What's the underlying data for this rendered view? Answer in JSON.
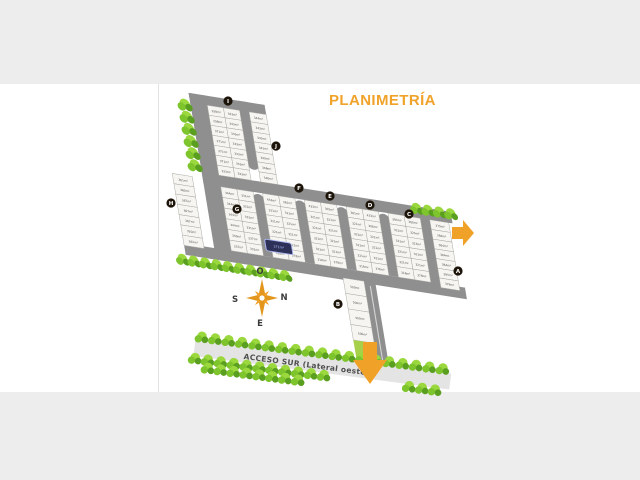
{
  "page": {
    "title": "PLANIMETRÍA"
  },
  "colors": {
    "canvas": "#ededed",
    "page": "#ffffff",
    "seam": "#e2e2e2",
    "title": "#f0a22a",
    "road": "#8f8f8f",
    "roadLine": "#d5d5d5",
    "lot": "#f6f5f2",
    "lotStroke": "#a6a6a0",
    "lotText": "#4c4c48",
    "tree": "#7dc42d",
    "treeLight": "#9bd83e",
    "treeDark": "#5a9f20",
    "accessRoad": "#e4e4e4",
    "accessText": "#4e4e4e",
    "orange": "#f0a128",
    "compassOrange": "#e3961c",
    "compassText": "#3b3b3b",
    "markerBg": "#1d1409",
    "markerText": "#ffffff",
    "highlight": "#2e3157",
    "highlightStroke": "#aab6f0",
    "highlightText": "#b9c3ff",
    "greenStrip": "#a6cf4a"
  },
  "plan": {
    "transform": [
      0.95,
      0.15,
      0.16,
      0.97,
      200,
      106
    ],
    "label_angle": 9,
    "roads": [
      {
        "name": "road-top-left",
        "u": -10,
        "v": -12,
        "w": 80,
        "h": 12
      },
      {
        "name": "road-a",
        "u": -10,
        "v": -12,
        "w": 19,
        "h": 164
      },
      {
        "name": "road-b-stub",
        "u": 42,
        "v": -12,
        "w": 10,
        "h": 66
      },
      {
        "name": "road-band-top",
        "u": -10,
        "v": 70,
        "w": 262,
        "h": 12
      },
      {
        "name": "road-band-bottom",
        "u": -42,
        "v": 148,
        "w": 296,
        "h": 12
      },
      {
        "name": "road-stub-1",
        "u": 42,
        "v": 86,
        "w": 10,
        "h": 62
      },
      {
        "name": "road-stub-2",
        "u": 86,
        "v": 86,
        "w": 10,
        "h": 62
      },
      {
        "name": "road-stub-3",
        "u": 130,
        "v": 86,
        "w": 10,
        "h": 62
      },
      {
        "name": "road-stub-4",
        "u": 174,
        "v": 86,
        "w": 10,
        "h": 62
      },
      {
        "name": "road-c-b",
        "u": 218,
        "v": 70,
        "w": 10,
        "h": 82
      },
      {
        "name": "road-south",
        "u": 146,
        "v": 158,
        "w": 12,
        "h": 90
      }
    ],
    "road_lines": [
      {
        "u": 151.4,
        "v": 162,
        "w": 1.2,
        "h": 82
      }
    ],
    "bulbs": [
      {
        "u": 47,
        "v": 52,
        "r": 6.5
      },
      {
        "u": 47,
        "v": 90,
        "r": 6.5
      },
      {
        "u": 91,
        "v": 90,
        "r": 6.5
      },
      {
        "u": 135,
        "v": 90,
        "r": 6.5
      },
      {
        "u": 179,
        "v": 90,
        "r": 6.5
      }
    ],
    "blocks": [
      {
        "name": "block-I",
        "u": 8,
        "v": -2,
        "colW": 17,
        "rowH": 10.3,
        "labels": [
          [
            "298m²",
            "343m²"
          ],
          [
            "298m²",
            "343m²"
          ],
          [
            "371m²",
            "333m²"
          ],
          [
            "371m²",
            "333m²"
          ],
          [
            "371m²",
            "333m²"
          ],
          [
            "371m²",
            "333m²"
          ],
          [
            "333m²",
            "333m²"
          ]
        ]
      },
      {
        "name": "block-J",
        "u": 52,
        "v": -2,
        "colW": 18,
        "rowH": 10.3,
        "labels": [
          [
            "344m²"
          ],
          [
            "343m²"
          ],
          [
            "343m²"
          ],
          [
            "341m²"
          ],
          [
            "340m²"
          ],
          [
            "348m²"
          ],
          [
            "340m²"
          ]
        ]
      },
      {
        "name": "block-H",
        "u": -42,
        "v": 76,
        "colW": 21,
        "rowH": 10.6,
        "labels": [
          [
            "361m²"
          ],
          [
            "380m²"
          ],
          [
            "367m²"
          ],
          [
            "367m²"
          ],
          [
            "367m²"
          ],
          [
            "320m²"
          ],
          [
            "362m²"
          ]
        ]
      },
      {
        "name": "block-G",
        "u": 8,
        "v": 82,
        "colW": 17,
        "rowH": 11,
        "labels": [
          [
            "344m²",
            "331m²"
          ],
          [
            "344m²",
            "331m²"
          ],
          [
            "344m²",
            "331m²"
          ],
          [
            "344m²",
            "331m²"
          ],
          [
            "330m²",
            "337m²"
          ],
          [
            "337m²",
            "331m²"
          ]
        ]
      },
      {
        "name": "block-F",
        "u": 52,
        "v": 82,
        "colW": 17,
        "rowH": 11,
        "labels": [
          [
            "453m²",
            "361m²"
          ],
          [
            "321m²",
            "321m²"
          ],
          [
            "321m²",
            "321m²"
          ],
          [
            "321m²",
            "321m²"
          ],
          [
            "321m²",
            "321m²"
          ],
          [
            "318m²",
            "378m²"
          ]
        ]
      },
      {
        "name": "block-E",
        "u": 96,
        "v": 82,
        "colW": 17,
        "rowH": 11,
        "labels": [
          [
            "433m²",
            "305m²"
          ],
          [
            "321m²",
            "321m²"
          ],
          [
            "321m²",
            "321m²"
          ],
          [
            "321m²",
            "321m²"
          ],
          [
            "321m²",
            "321m²"
          ],
          [
            "318m²",
            "378m²"
          ]
        ]
      },
      {
        "name": "block-D",
        "u": 140,
        "v": 82,
        "colW": 17,
        "rowH": 11,
        "labels": [
          [
            "381m²",
            "433m²"
          ],
          [
            "321m²",
            "306m²"
          ],
          [
            "321m²",
            "321m²"
          ],
          [
            "321m²",
            "321m²"
          ],
          [
            "321m²",
            "321m²"
          ],
          [
            "318m²",
            "378m²"
          ]
        ]
      },
      {
        "name": "block-C",
        "u": 184,
        "v": 82,
        "colW": 17,
        "rowH": 11,
        "labels": [
          [
            "383m²",
            "380m²"
          ],
          [
            "321m²",
            "323m²"
          ],
          [
            "321m²",
            "323m²"
          ],
          [
            "321m²",
            "321m²"
          ],
          [
            "321m²",
            "321m²"
          ],
          [
            "318m²",
            "378m²"
          ]
        ]
      },
      {
        "name": "block-B",
        "u": 228,
        "v": 82,
        "colW": 20,
        "rowH": 10,
        "labels": [
          [
            "379m²"
          ],
          [
            "384m²"
          ],
          [
            "384m²"
          ],
          [
            "384m²"
          ],
          [
            "384m²"
          ],
          [
            "384m²"
          ],
          [
            "378m²"
          ]
        ]
      },
      {
        "name": "block-A",
        "u": 124,
        "v": 158,
        "colW": 22,
        "rowH": 16,
        "labels": [
          [
            "500m²"
          ],
          [
            "500m²"
          ],
          [
            "500m²"
          ],
          [
            "500m²"
          ]
        ]
      }
    ],
    "green_strip": {
      "u": 124,
      "v": 222,
      "w": 22,
      "h": 22
    },
    "highlight": {
      "u": 46,
      "v": 130,
      "w": 28,
      "h": 12,
      "label": "371m²"
    },
    "tree_lines": [
      {
        "name": "trees-left-column",
        "u": -16,
        "v": 2,
        "dx": 0,
        "dy": 12.5,
        "n": 6,
        "s": 1.1
      },
      {
        "name": "trees-band-bottom-left",
        "u": -46,
        "v": 166,
        "dx": 12,
        "dy": 0,
        "n": 10,
        "s": 1.0
      },
      {
        "name": "trees-band-top-right",
        "u": 216,
        "v": 73,
        "dx": 12,
        "dy": 0,
        "n": 4,
        "s": 1.0
      }
    ]
  },
  "markers": [
    {
      "label": "I",
      "x": 228,
      "y": 101
    },
    {
      "label": "J",
      "x": 276,
      "y": 146
    },
    {
      "label": "H",
      "x": 171,
      "y": 203
    },
    {
      "label": "G",
      "x": 237,
      "y": 209
    },
    {
      "label": "F",
      "x": 299,
      "y": 188
    },
    {
      "label": "E",
      "x": 330,
      "y": 196
    },
    {
      "label": "D",
      "x": 370,
      "y": 205
    },
    {
      "label": "C",
      "x": 409,
      "y": 214
    },
    {
      "label": "B",
      "x": 338,
      "y": 304
    },
    {
      "label": "A",
      "x": 458,
      "y": 271
    }
  ],
  "compass": {
    "cx": 262,
    "cy": 298,
    "labels": {
      "top": "O",
      "right": "N",
      "left": "S",
      "bottom": "E"
    },
    "offsets": {
      "top": [
        -2,
        -24
      ],
      "right": [
        22,
        2
      ],
      "left": [
        -27,
        4
      ],
      "bottom": [
        -2,
        28
      ]
    }
  },
  "access_road": {
    "label": "ACCESO SUR (Lateral oeste)",
    "x": 196,
    "y": 336,
    "angle": 7.5,
    "len": 258,
    "tree_rows": [
      {
        "x": 6,
        "y": 1,
        "dx": 13.5,
        "n": 19
      },
      {
        "x": 2,
        "y": 23,
        "dx": 13,
        "n": 11
      },
      {
        "x": 16,
        "y": 31,
        "dx": 13,
        "n": 8
      },
      {
        "x": 218,
        "y": 23,
        "dx": 13,
        "n": 3
      }
    ]
  },
  "arrows": [
    {
      "dir": "right",
      "x": 452,
      "y": 220
    },
    {
      "dir": "down",
      "x": 353,
      "y": 342
    }
  ]
}
